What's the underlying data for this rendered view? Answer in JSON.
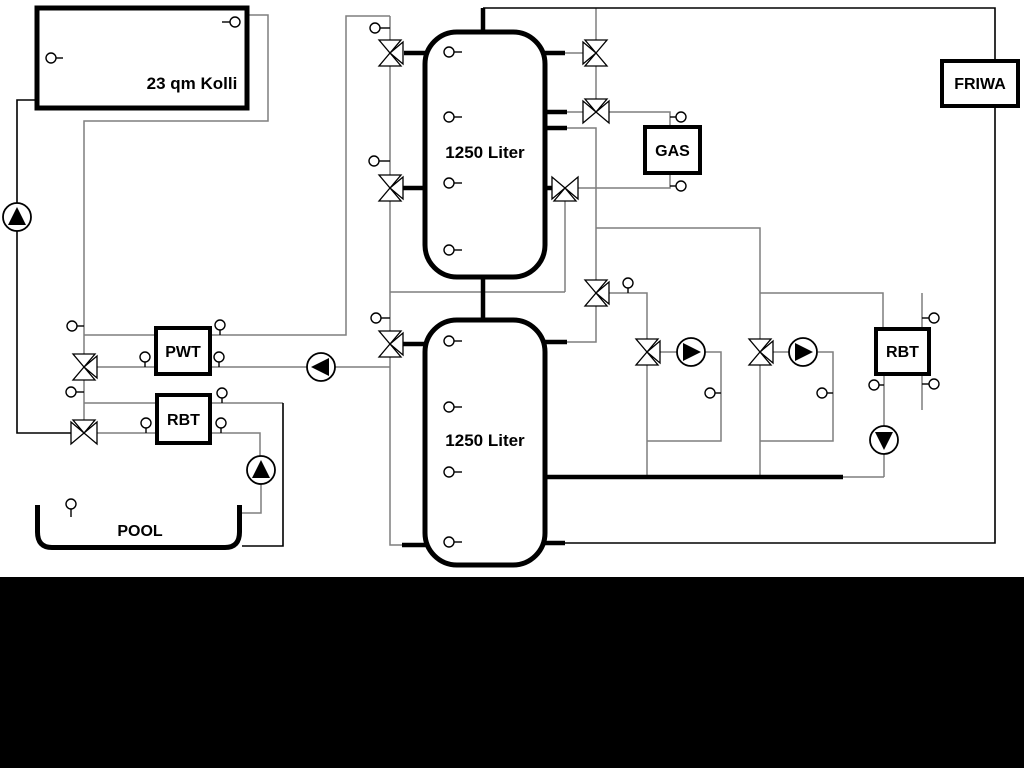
{
  "labels": {
    "collector": "23 qm Kolli",
    "tank_top": "1250 Liter",
    "tank_bottom": "1250 Liter",
    "pwt": "PWT",
    "rbt_left": "RBT",
    "pool": "POOL",
    "gas": "GAS",
    "friwa": "FRIWA",
    "rbt_right": "RBT"
  },
  "colors": {
    "pipe_gray": "#7f7f7f",
    "line_black": "#000000",
    "canvas": "#ffffff",
    "footer_bar": "#000000"
  }
}
